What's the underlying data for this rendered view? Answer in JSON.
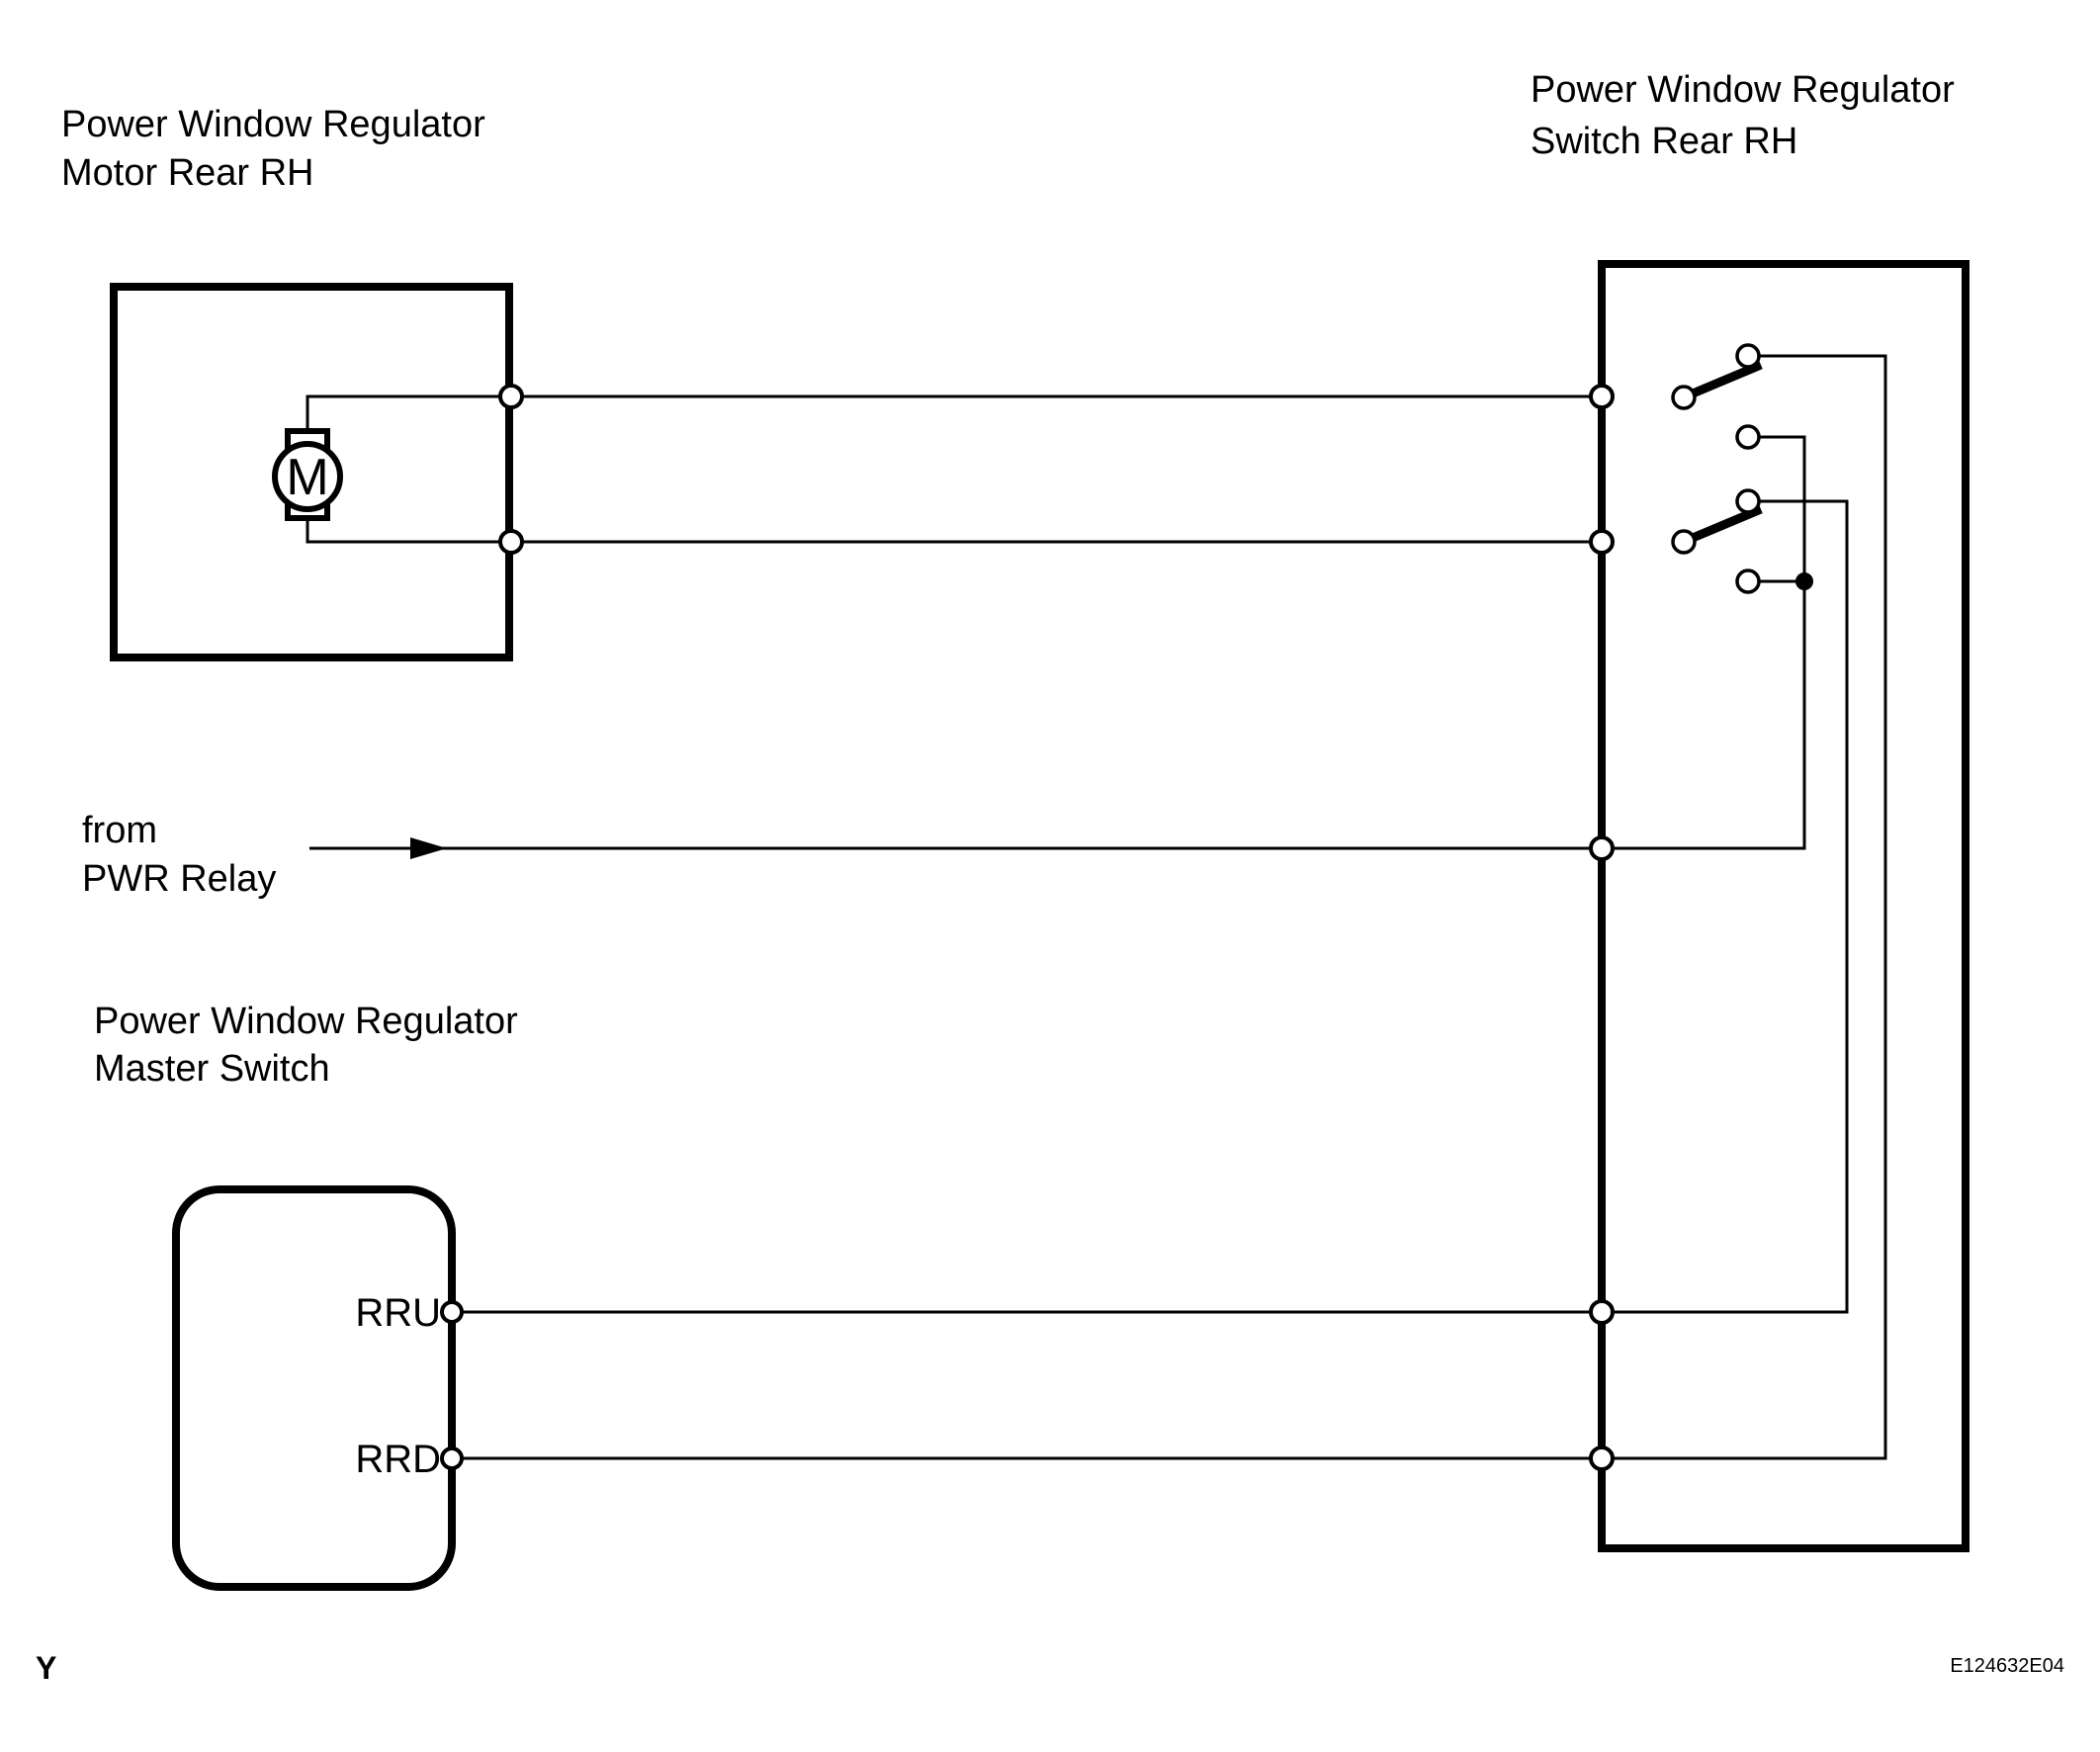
{
  "page": {
    "background": "#ffffff",
    "line_color": "#000000",
    "code_color": "#333333"
  },
  "components": {
    "motor": {
      "title_line1": "Power Window Regulator",
      "title_line2": "Motor Rear RH",
      "symbol": "M"
    },
    "rear_switch": {
      "title_line1": "Power Window Regulator",
      "title_line2": "Switch Rear RH"
    },
    "master_switch": {
      "title_line1": "Power Window Regulator",
      "title_line2": "Master Switch",
      "pin_up": "RRU",
      "pin_down": "RRD"
    },
    "source": {
      "line1": "from",
      "line2": "PWR Relay"
    }
  },
  "footer": {
    "page_marker": "Y",
    "figure_code": "E124632E04"
  }
}
